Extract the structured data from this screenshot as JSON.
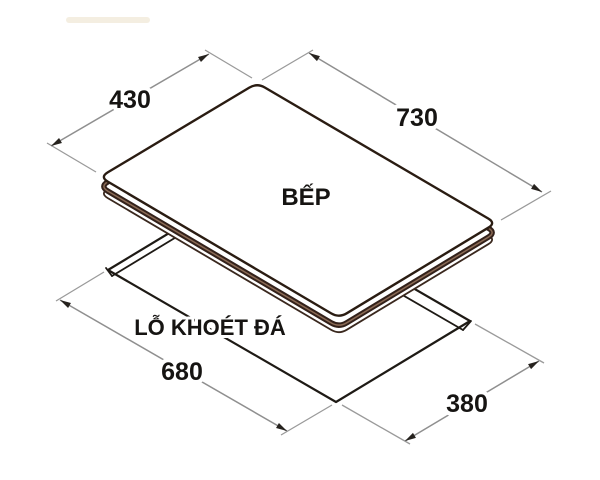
{
  "drawing": {
    "product_label": "BẾP",
    "cutout_label": "LỖ KHOÉT ĐÁ",
    "dims": {
      "top_depth": "430",
      "top_width": "730",
      "cutout_width": "680",
      "cutout_depth": "380"
    },
    "colors": {
      "background": "#ffffff",
      "glass_outline": "#2a1c12",
      "body_band": "#33211a",
      "band_highlight": "#8a6a55",
      "cutout_line": "#1e1a15",
      "dimension_line": "#8f8f8f",
      "arrow": "#26221e",
      "text": "#161412"
    }
  }
}
